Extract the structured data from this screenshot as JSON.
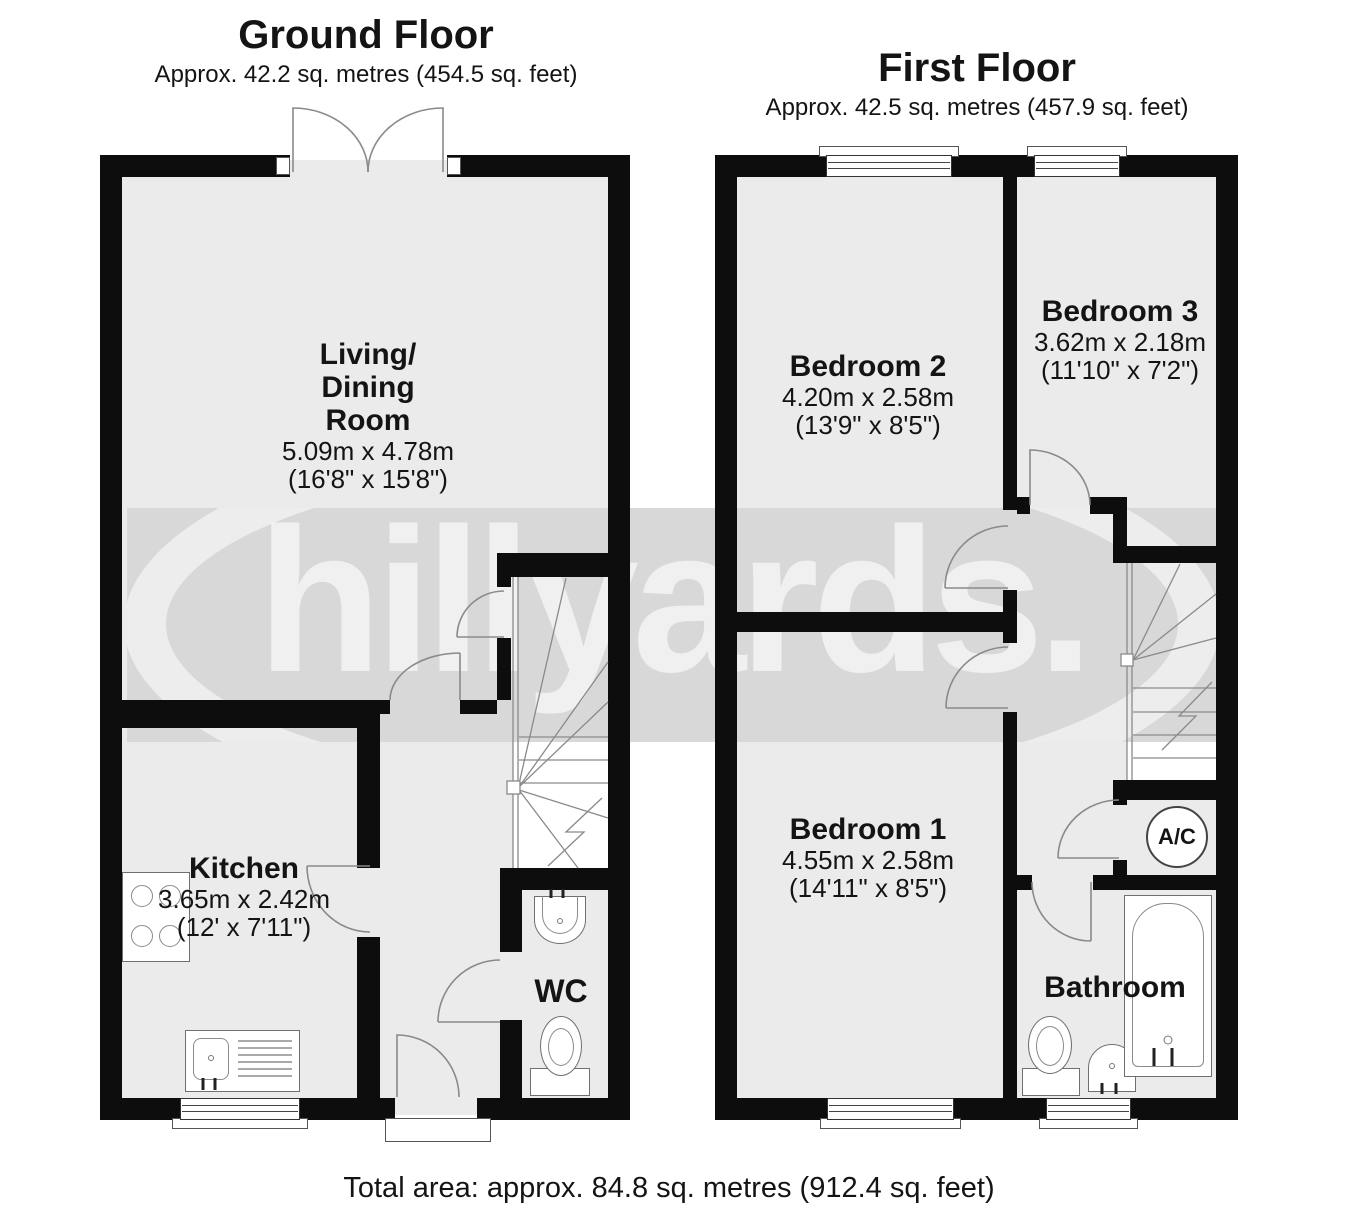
{
  "ground_floor": {
    "title": "Ground Floor",
    "subtitle": "Approx. 42.2 sq. metres (454.5 sq. feet)",
    "rooms": {
      "living": {
        "name_line1": "Living/",
        "name_line2": "Dining",
        "name_line3": "Room",
        "dim_m": "5.09m x 4.78m",
        "dim_ft": "(16'8\" x 15'8\")"
      },
      "kitchen": {
        "name": "Kitchen",
        "dim_m": "3.65m x 2.42m",
        "dim_ft": "(12' x 7'11\")"
      },
      "wc": {
        "name": "WC"
      }
    }
  },
  "first_floor": {
    "title": "First Floor",
    "subtitle": "Approx. 42.5 sq. metres (457.9 sq. feet)",
    "rooms": {
      "bedroom2": {
        "name": "Bedroom 2",
        "dim_m": "4.20m x 2.58m",
        "dim_ft": "(13'9\" x 8'5\")"
      },
      "bedroom3": {
        "name": "Bedroom 3",
        "dim_m": "3.62m x 2.18m",
        "dim_ft": "(11'10\" x 7'2\")"
      },
      "bedroom1": {
        "name": "Bedroom 1",
        "dim_m": "4.55m x 2.58m",
        "dim_ft": "(14'11\" x 8'5\")"
      },
      "bathroom": {
        "name": "Bathroom"
      },
      "airing_cupboard": {
        "name": "A/C"
      }
    }
  },
  "watermark": {
    "text": "hillyards."
  },
  "footer": {
    "total_area": "Total area: approx. 84.8 sq. metres (912.4 sq. feet)"
  },
  "colors": {
    "wall": "#0d0d0d",
    "room_fill": "#ebebeb",
    "watermark_band": "#d8d8d8"
  }
}
